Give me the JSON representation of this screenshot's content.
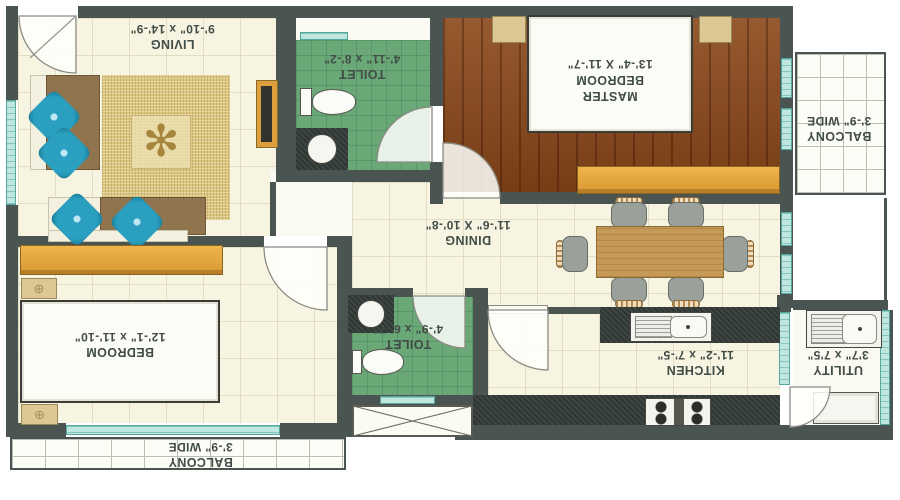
{
  "plan": {
    "rooms": {
      "living": {
        "name": "LIVING",
        "dims": "9'-10\" x 14'-9\""
      },
      "toilet1": {
        "name": "TOILET",
        "dims": "4'-11\" x 8'-2\""
      },
      "master_bedroom": {
        "name": "MASTER BEDROOM",
        "dims": "13'-4\" X 11'-7\""
      },
      "balcony_top": {
        "name": "BALCONY",
        "dims": "3'-9\" WIDE"
      },
      "dining": {
        "name": "DINING",
        "dims": "11'-6\" X 10'-8\""
      },
      "bedroom": {
        "name": "BEDROOM",
        "dims": "12'-1\" x 11'-10\""
      },
      "toilet2": {
        "name": "TOILET",
        "dims": "4'-9\" x 6'-7\""
      },
      "kitchen": {
        "name": "KITCHEN",
        "dims": "11'-2\" x 7'-5\""
      },
      "utility": {
        "name": "UTILITY",
        "dims": "3'7\" x 7'5\""
      },
      "balcony_bottom": {
        "name": "BALCONY",
        "dims": "3'-9\" WIDE"
      }
    },
    "palette": {
      "wall": "#4a5450",
      "floor": "#f7f4e2",
      "toilet_tile": "#6aa878",
      "wood_floor": "#8a4719",
      "wardrobe": "#e2a33c",
      "window": "#bfe7e0",
      "counter": "#2f3734",
      "rug": "#dcc67e",
      "pillow": "#2a9fc0",
      "label_text": "#414c46"
    },
    "motif_glyph": "✻",
    "nightstand_glyph": "⊕"
  }
}
